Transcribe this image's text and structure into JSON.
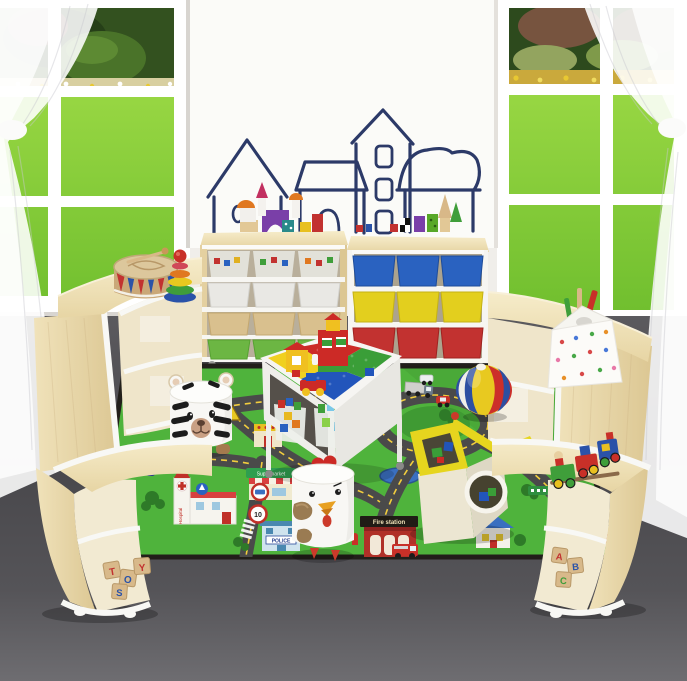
{
  "scene": {
    "description": "Children playroom furniture set: two storage units with colorful bins in front of a whiteboard with house drawings, curved wooden corner benches, quarter-circle shelves, a LEGO play table, tiger and chicken stools, a yellow shape-sorter house and a beach ball on a green road play mat, windows with sheer curtains and garden view",
    "labels": {
      "fire_station": "Fire station",
      "police": "POLICE",
      "supermarket": "Supermarket",
      "hospital": "Hospital",
      "tv": "TV",
      "speed_limit": "10",
      "left_blocks": [
        "T",
        "O",
        "Y",
        "S"
      ],
      "right_blocks": [
        "A",
        "B",
        "C"
      ]
    },
    "palette": {
      "wall": "#f0eeea",
      "whiteboard": "#fbfbf8",
      "drawing_ink": "#2c3a68",
      "lawn": "#84cc35",
      "bush_dark": "#2f4d20",
      "window_frame": "#ffffff",
      "floor_dark": "#48474b",
      "floor_light": "#6e6d71",
      "wood_light": "#f4e9c6",
      "wood_mid": "#e9d8ab",
      "trim_white": "#f8f8f5",
      "bin_clear": "#e6e6df",
      "bin_white": "#e9e8e4",
      "bin_tan": "#d9c08e",
      "bin_green": "#6cb643",
      "bin_blue": "#2a62c0",
      "bin_yellow": "#e3cf1e",
      "bin_red": "#c23230",
      "mat_green": "#4fb33c",
      "road_gray": "#4a4a4a",
      "road_dash_yellow": "#f2cd3e",
      "ball_blue": "#2d4fa1",
      "ball_yellow": "#e8c920",
      "ball_red": "#cc2f2a",
      "house_cream": "#ece6d2",
      "house_yellow": "#e6d51e",
      "lego_yellow": "#f0d020",
      "lego_red": "#cc2a26",
      "lego_blue": "#2255bb",
      "lego_green": "#3a9e38",
      "stool_white": "#f8f7f4",
      "chicken_brown": "#9a7b52"
    }
  }
}
